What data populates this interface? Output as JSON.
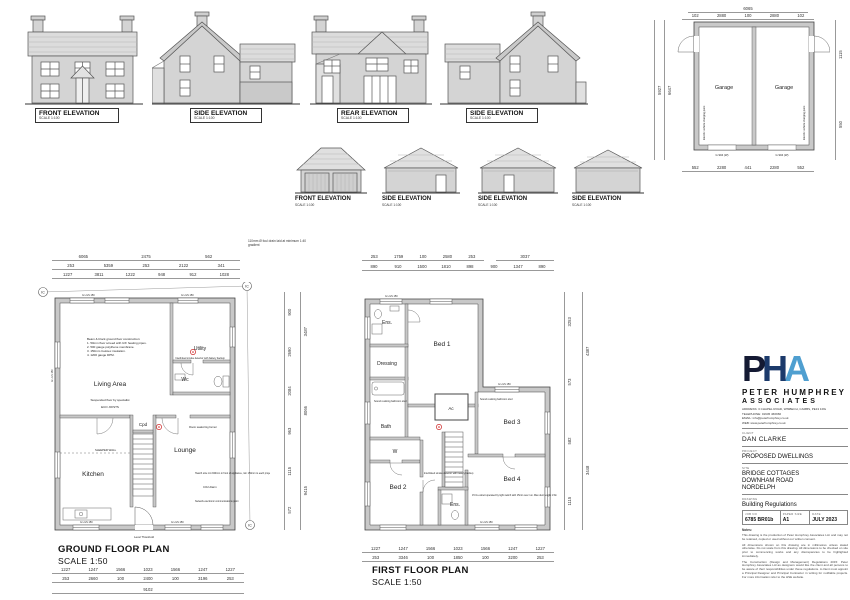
{
  "sheet": {
    "background": "#ffffff",
    "line_color": "#444444",
    "wall_fill": "#c8c8c8",
    "accent_red": "#cc2222"
  },
  "house_elevations": [
    {
      "label": "FRONT ELEVATION",
      "scale": "SCALE 1:100"
    },
    {
      "label": "SIDE ELEVATION",
      "scale": "SCALE 1:100"
    },
    {
      "label": "REAR ELEVATION",
      "scale": "SCALE 1:100"
    },
    {
      "label": "SIDE ELEVATION",
      "scale": "SCALE 1:100"
    }
  ],
  "garage_elevations": [
    {
      "label": "FRONT ELEVATION",
      "scale": "SCALE 1:100"
    },
    {
      "label": "SIDE ELEVATION",
      "scale": "SCALE 1:100"
    },
    {
      "label": "SIDE ELEVATION",
      "scale": "SCALE 1:100"
    },
    {
      "label": "SIDE ELEVATION",
      "scale": "SCALE 1:100"
    }
  ],
  "garage_plan": {
    "room_left": "Garage",
    "room_right": "Garage",
    "dim_total_top": [
      "6065"
    ],
    "dims_top": [
      "102",
      "2880",
      "100",
      "2880",
      "102"
    ],
    "dims_bottom": [
      "552",
      "2280",
      "441",
      "2280",
      "552"
    ],
    "dims_left_outer": [
      "5927"
    ],
    "dims_left_inner": [
      "6647"
    ],
    "dims_right": [
      "1115",
      "550"
    ],
    "ev_note_left": "Electric vehicle charging point",
    "ev_note_right": "Electric vehicle charging point",
    "door_width_left": "G 904 (W)",
    "door_width_right": "G 904 (W)"
  },
  "ground_floor": {
    "title": "GROUND FLOOR PLAN",
    "scale": "SCALE 1:50",
    "rooms": {
      "living": "Living Area",
      "utility": "Utility",
      "wc": "Wc",
      "cpd": "Cpd",
      "kitchen": "Kitchen",
      "lounge": "Lounge"
    },
    "floor_notes": [
      "Beam & block ground floor construction:",
      "1. 50mm floor screed with U/F heating pipes.",
      "2. 500 gauge polythene membrane.",
      "3. 150mm Celotex insulation.",
      "4. 1200 gauge DPM."
    ],
    "annotations": {
      "foul_drain": "110mm Ø foul drain laid at minimum 1:40 gradient",
      "suspended_floor": "Suspended floor by specialist",
      "eco_joists": "ECO JOISTS",
      "smoke": "Interlinked smoke detector with battery backup",
      "sleeper_wall": "SLEEPER WALL",
      "log_burner": "Room sealed log burner",
      "hearth": "Hearth size min 840mm in front of appliance, min 150mm to each projection",
      "co2": "CO2 Alarm",
      "network": "Network electronic communications point",
      "level_threshold": "Level Threshold",
      "lintel": "G L/LS 150",
      "ic": "IC"
    },
    "dims_top_1": [
      "6065",
      "2475",
      "562"
    ],
    "dims_top_2": [
      "253",
      "5359",
      "253",
      "2122",
      "341"
    ],
    "dims_top_3": [
      "1227",
      "3811",
      "1222",
      "948",
      "912",
      "1028"
    ],
    "dims_bottom_1": [
      "1227",
      "1247",
      "1566",
      "1023",
      "1566",
      "1247",
      "1227"
    ],
    "dims_bottom_2": [
      "253",
      "2660",
      "100",
      "2400",
      "100",
      "3196",
      "253"
    ],
    "dims_bottom_total": [
      "9102"
    ],
    "dims_right_1": [
      "900",
      "2690",
      "2084",
      "963",
      "1115",
      "572"
    ],
    "dims_right_2": [
      "3487",
      "8066",
      "9415"
    ]
  },
  "first_floor": {
    "title": "FIRST FLOOR PLAN",
    "scale": "SCALE 1:50",
    "rooms": {
      "ens1": "Ens.",
      "bed1": "Bed 1",
      "dressing": "Dressing",
      "bath": "Bath",
      "ac": "Ac",
      "bed3": "Bed 3",
      "w": "W",
      "bed2": "Bed 2",
      "bed4": "Bed 4",
      "ens2": "Ens."
    },
    "annotations": {
      "sound_stud": "Sound resisting bathroom stud",
      "extract": "15 l/s extract operated by light switch with 15min over run. Max duct length 1.5m",
      "smoke": "Interlinked smoke detector with battery backup",
      "lintel": "G L/LS 150"
    },
    "dims_top_1": [
      "253",
      "1759",
      "100",
      "2580",
      "253"
    ],
    "dims_top_1b": [
      "3037"
    ],
    "dims_top_2": [
      "890",
      "910",
      "1500",
      "1810",
      "898",
      "900",
      "1347",
      "890"
    ],
    "dims_bottom_1": [
      "1227",
      "1247",
      "1566",
      "1023",
      "1566",
      "1247",
      "1227"
    ],
    "dims_bottom_2": [
      "253",
      "3346",
      "100",
      "1850",
      "100",
      "3200",
      "253"
    ],
    "dims_right_1": [
      "3253",
      "573",
      "582",
      "1115"
    ],
    "dims_right_2": [
      "4387",
      "3448"
    ]
  },
  "title_block": {
    "logo_p": "P",
    "logo_h": "H",
    "logo_a": "A",
    "logo_colors": {
      "p": "#141a33",
      "h": "#1c3a6b",
      "a": "#4f9fd0"
    },
    "company_line1": "PETER HUMPHREY",
    "company_line2": "ASSOCIATES",
    "address": "ADDRESS: 3 CHAPEL ROAD, WISBECH, CAMBS, PE13 1RG",
    "telephone": "TELEPHONE: 01945 466966",
    "email": "EMAIL: info@peterhumphrey.co.uk",
    "web": "WEB: www.peterhumphrey.co.uk",
    "client_label": "CLIENT",
    "client": "DAN CLARKE",
    "project_label": "PROJECT",
    "project": "PROPOSED DWELLINGS",
    "site_label": "SITE",
    "site_lines": [
      "BRIDGE COTTAGES",
      "DOWNHAM ROAD",
      "NORDELPH"
    ],
    "drawing_label": "DRAWING",
    "drawing": "Building Regulations",
    "job_no_label": "JOB NO",
    "job_no": "6785 BR01b",
    "paper_label": "PAPER SIZE",
    "paper": "A1",
    "date_label": "DATE",
    "date": "JULY 2023",
    "notes_label": "Notes:",
    "note1": "This drawing is the production of Peter Humphrey Associates Ltd. and may not be retained, copied or used without our written consent.",
    "note2": "All dimensions shown on this drawing are in millimetres unless stated otherwise. Do not scale from this drawing. All dimensions to be checked on site prior to commencing works and any discrepancies to be highlighted immediately.",
    "note3": "The Construction (Design and Management) Regulations 2015: Peter Humphrey Associates Ltd as designers would like the client and all persons to be aware of their responsibilities under these regulations. A client must appoint a Principal Designer and Principal Contractor in writing for notifiable projects. For more information refer to the HSE website."
  }
}
